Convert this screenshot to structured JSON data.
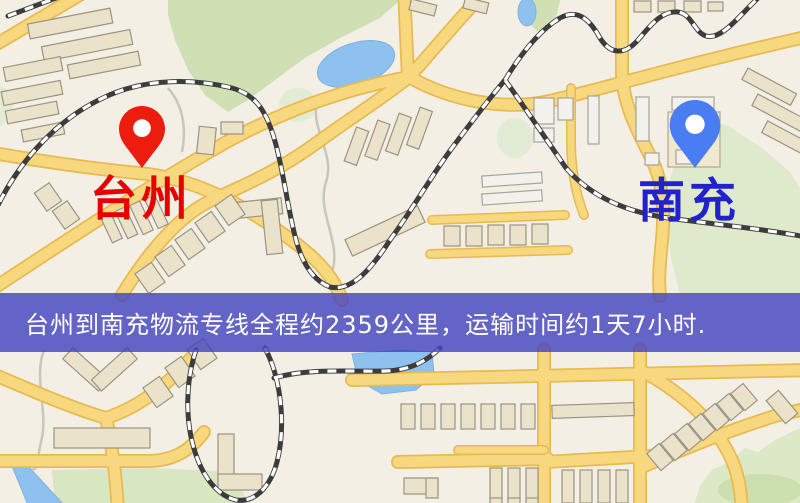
{
  "banner": {
    "text": "台州到南充物流专线全程约2359公里，运输时间约1天7小时.",
    "bg_color": "#4446c0",
    "bg_opacity": 0.82,
    "text_color": "#ffffff"
  },
  "origin_marker": {
    "label": "台州",
    "label_color": "#e60000",
    "pin_color": "#ec1c0f",
    "pin_icon": "map-pin"
  },
  "destination_marker": {
    "label": "南充",
    "label_color": "#2222cc",
    "pin_color": "#4b7df2",
    "pin_icon": "map-pin"
  },
  "map_palette": {
    "background": "#f4efe5",
    "road_fill": "#f8d87e",
    "road_casing": "#e7ba52",
    "building": "#ebe3c9",
    "green_area": "#cfe0b4",
    "water": "#8fc1ee",
    "railway": "#3c3c3c"
  }
}
